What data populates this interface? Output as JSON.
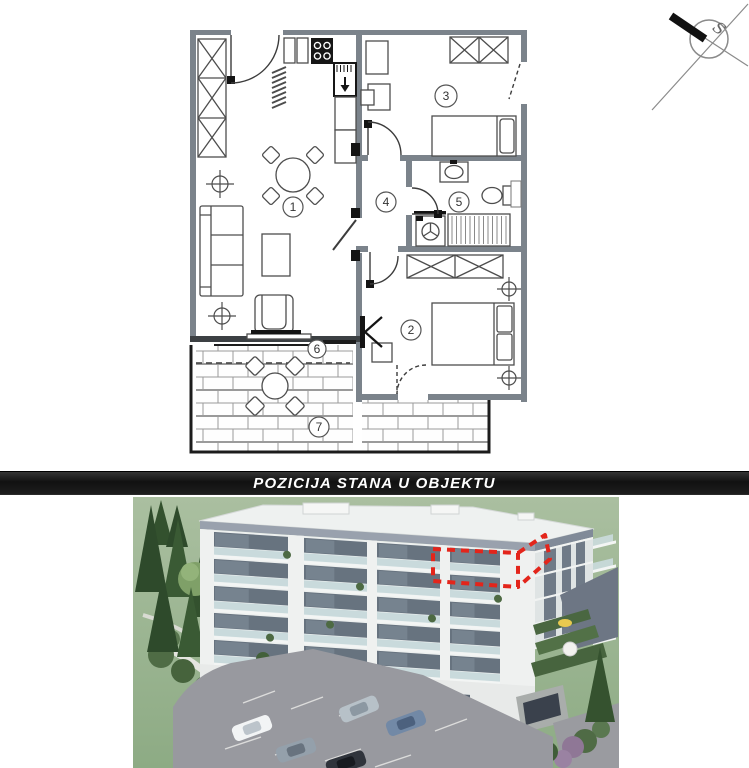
{
  "banner": {
    "title": "POZICIJA STANA U OBJEKTU"
  },
  "floor_plan": {
    "room_labels": [
      "1",
      "2",
      "3",
      "4",
      "5",
      "6",
      "7"
    ],
    "compass_letter": "S"
  },
  "colors": {
    "banner_background": "#161616",
    "banner_text": "#ffffff",
    "wall_gray": "#7b838b",
    "highlight_red": "#e3251b",
    "grass_green": "#9db794",
    "building_white": "#eff1f1"
  }
}
